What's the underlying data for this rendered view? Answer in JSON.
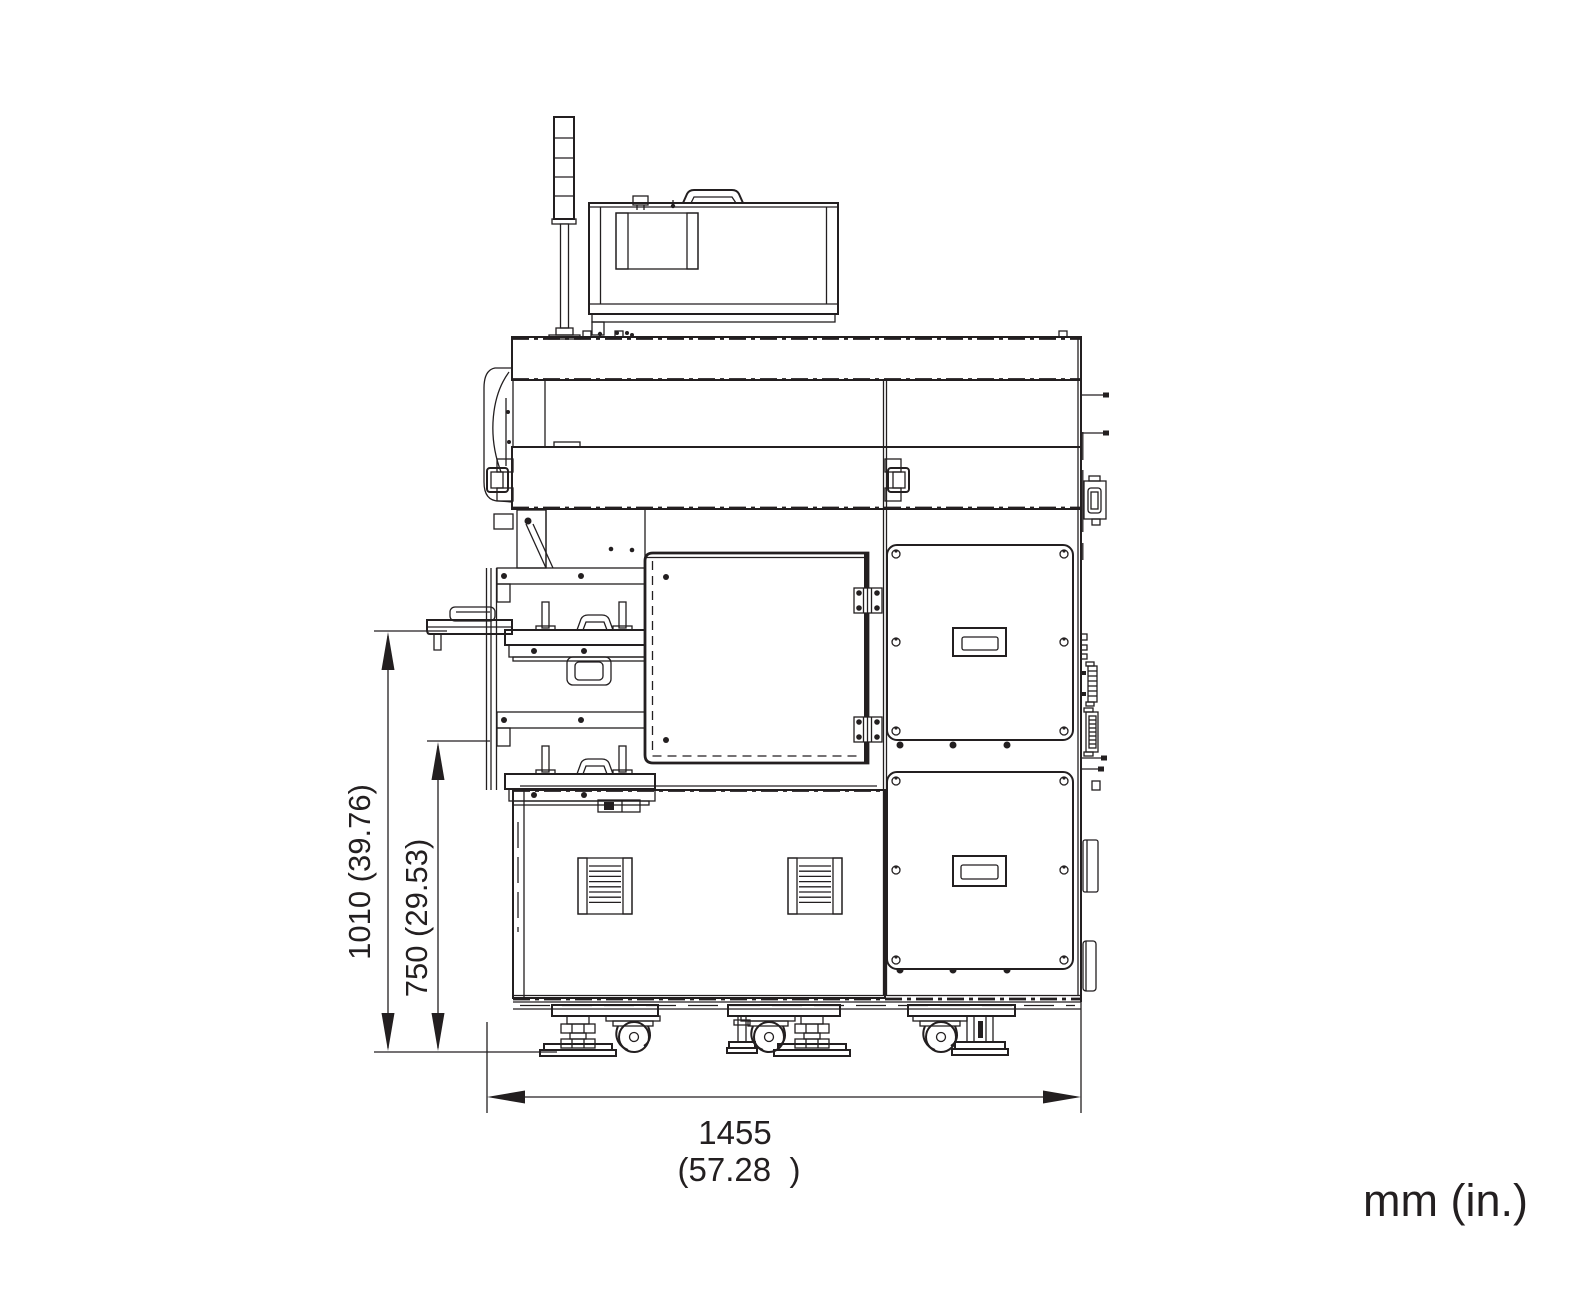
{
  "drawing": {
    "background": "#ffffff",
    "line_color": "#231f20"
  },
  "annotations": {
    "units_label": "mm (in.)",
    "dim_height_overall": {
      "mm": "1010",
      "inches": "39.76",
      "label": "1010 (39.76)"
    },
    "dim_height_upper": {
      "mm": "750",
      "inches": "29.53",
      "label": "750 (29.53)"
    },
    "dim_width_overall": {
      "mm": "1455",
      "inches": "57.28",
      "label_mm": "1455",
      "label_inches": "(57.28  )"
    }
  }
}
